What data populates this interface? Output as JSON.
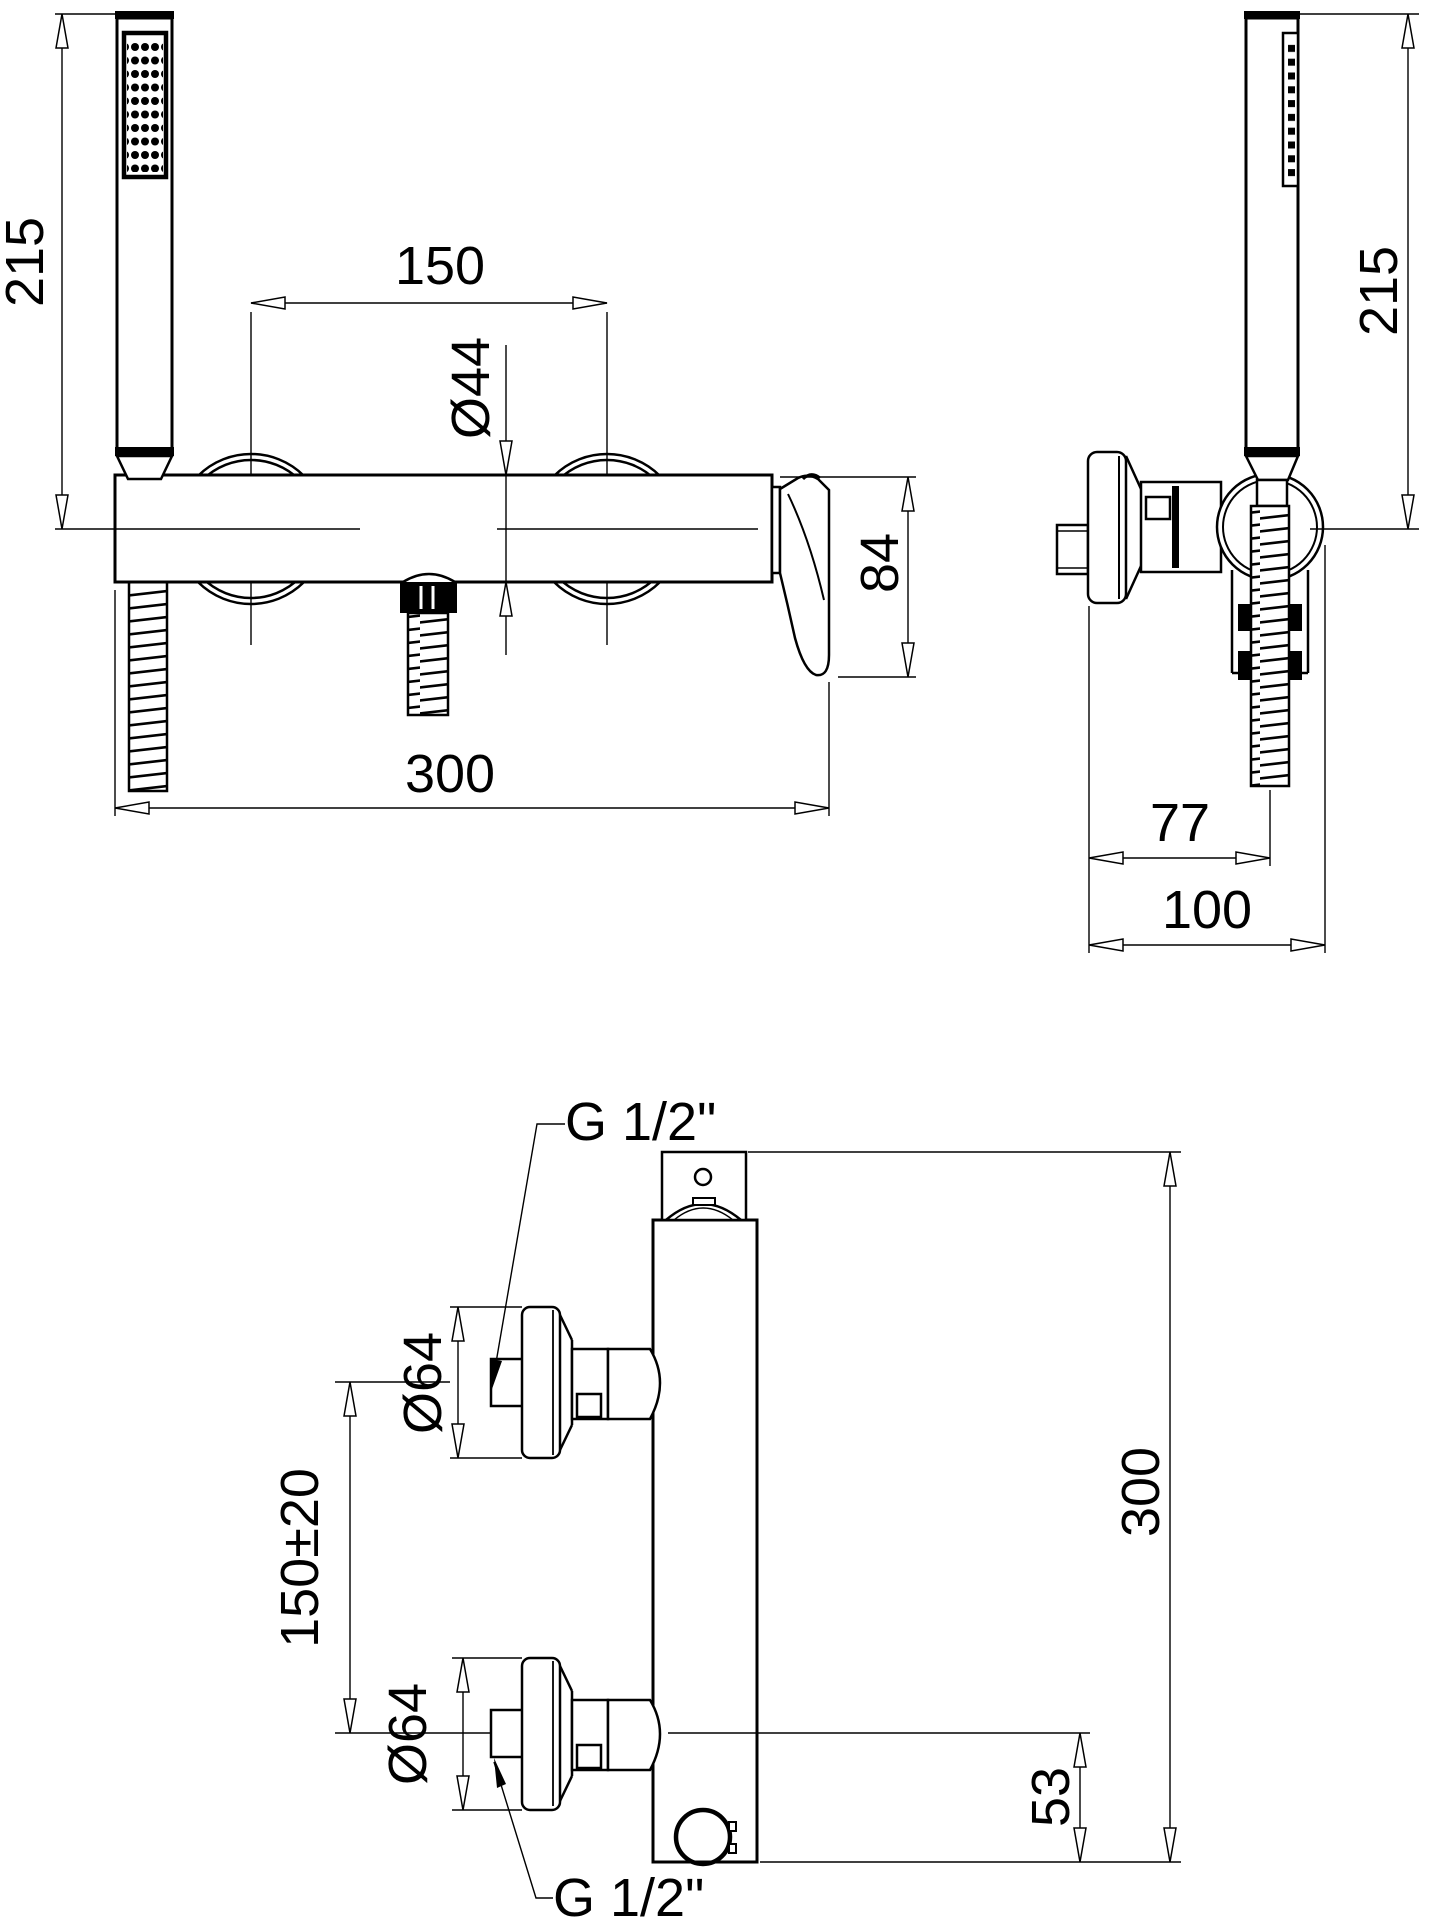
{
  "drawing": {
    "background_color": "#ffffff",
    "line_color": "#000000",
    "views": {
      "front": {
        "dim_handshower_height": "215",
        "dim_center_spacing": "150",
        "dim_body_diameter": "Ø44",
        "dim_handle_drop": "84",
        "dim_overall_width": "300"
      },
      "side": {
        "dim_handshower_height": "215",
        "dim_wall_to_hose": "77",
        "dim_overall_depth": "100"
      },
      "mounting": {
        "label_thread_top": "G 1/2\"",
        "label_thread_bottom": "G 1/2\"",
        "dim_flange_diameter_top": "Ø64",
        "dim_flange_diameter_bottom": "Ø64",
        "dim_inlet_spacing": "150±20",
        "dim_overall_height": "300",
        "dim_outlet_offset": "53"
      }
    }
  }
}
